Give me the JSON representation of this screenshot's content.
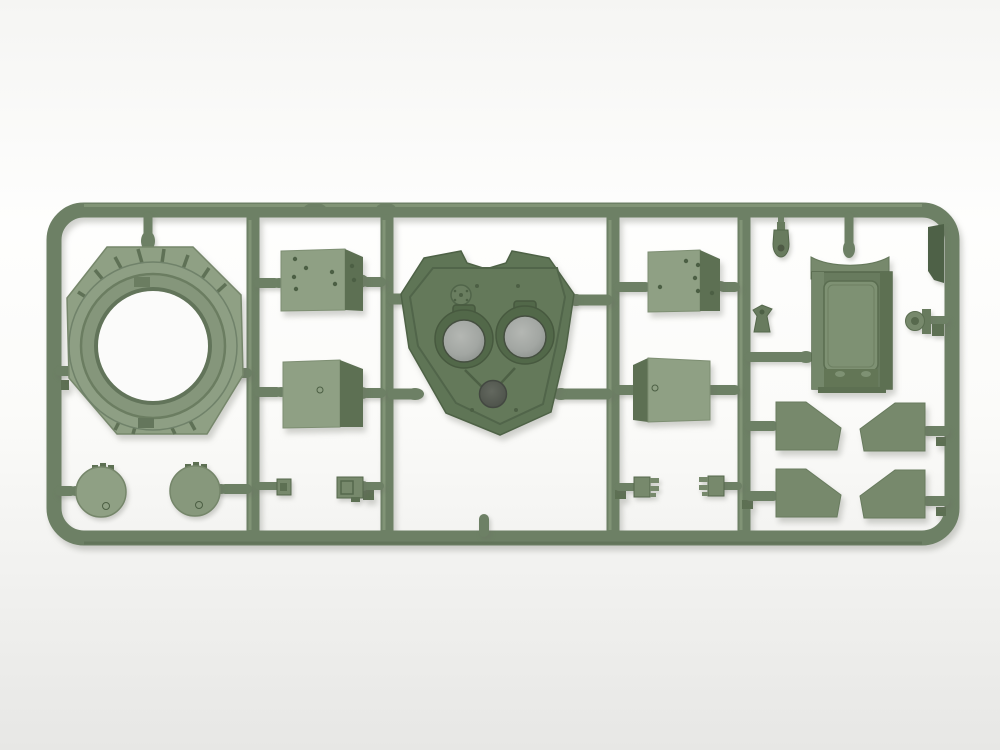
{
  "meta": {
    "description": "Photograph of an olive-green injection-moulded plastic sprue (parts frame) from a tank model kit, lying on a white background. The rectangular runner frame holds a turret ring, a turret roof with two periscope openings, two round hatch covers, four folded armour panels with bolt holes, a stowage bin, four angled fender plates and several small fittings.",
    "kit_type": "plastic model kit sprue",
    "plastic_color_name": "olive green",
    "background": "seamless white studio backdrop"
  },
  "colors": {
    "bg_top": "#f5f5f3",
    "bg_mid": "#fefefd",
    "bg_mid2": "#fbfbf9",
    "bg_bottom": "#e7e7e5",
    "bg_hole": "#fbfbfa",
    "rail": "#6d8065",
    "rail_hi": "#95a787",
    "rail_lo": "#55684d",
    "plastic_light": "#8fa084",
    "plastic_mid": "#77896c",
    "plastic_mid2": "#687b5e",
    "plastic_dark": "#5d7053",
    "turret": "#5f7556",
    "turret_inner": "#667c5c",
    "collar": "#526849",
    "line_dark": "#4c5f44",
    "gray_hi": "#b2b5b1",
    "gray_lo": "#8b908c",
    "hole_dark": "#575c53",
    "tab_dark": "#4e6147",
    "shadow": "rgba(105,110,98,0.30)"
  },
  "parts": [
    {
      "id": "turret-ring",
      "label": "Turret ring base with ribbed flange"
    },
    {
      "id": "turret-roof",
      "label": "Turret roof with two periscope openings and pistol port"
    },
    {
      "id": "round-hatch-1",
      "label": "Round hatch cover with hinge"
    },
    {
      "id": "round-hatch-2",
      "label": "Round hatch cover with hinge"
    },
    {
      "id": "armor-panel-left-top",
      "label": "Folded armour panel with bolt holes"
    },
    {
      "id": "armor-panel-left-bottom",
      "label": "Folded armour panel"
    },
    {
      "id": "armor-panel-right-top",
      "label": "Folded armour panel with bolt holes"
    },
    {
      "id": "armor-panel-right-bottom",
      "label": "Folded armour panel"
    },
    {
      "id": "stowage-bin",
      "label": "Stowage bin with recessed lid and latches"
    },
    {
      "id": "fender-plate-1",
      "label": "Angled fender plate"
    },
    {
      "id": "fender-plate-2",
      "label": "Angled fender plate (mirrored)"
    },
    {
      "id": "fender-plate-3",
      "label": "Angled fender plate"
    },
    {
      "id": "fender-plate-4",
      "label": "Angled fender plate (mirrored)"
    },
    {
      "id": "hinge-comb-1",
      "label": "Small hinge bracket"
    },
    {
      "id": "hinge-comb-2",
      "label": "Small hinge bracket"
    },
    {
      "id": "small-box",
      "label": "Small box fitting"
    },
    {
      "id": "small-bracket",
      "label": "Small bracket fitting"
    },
    {
      "id": "light-knob",
      "label": "Small lamp / lifting-eye part"
    },
    {
      "id": "valve-bracket",
      "label": "Small winged fitting"
    },
    {
      "id": "clamp",
      "label": "Small clamp fitting"
    },
    {
      "id": "sprue-tab",
      "label": "Moulded identification tab on frame"
    }
  ]
}
